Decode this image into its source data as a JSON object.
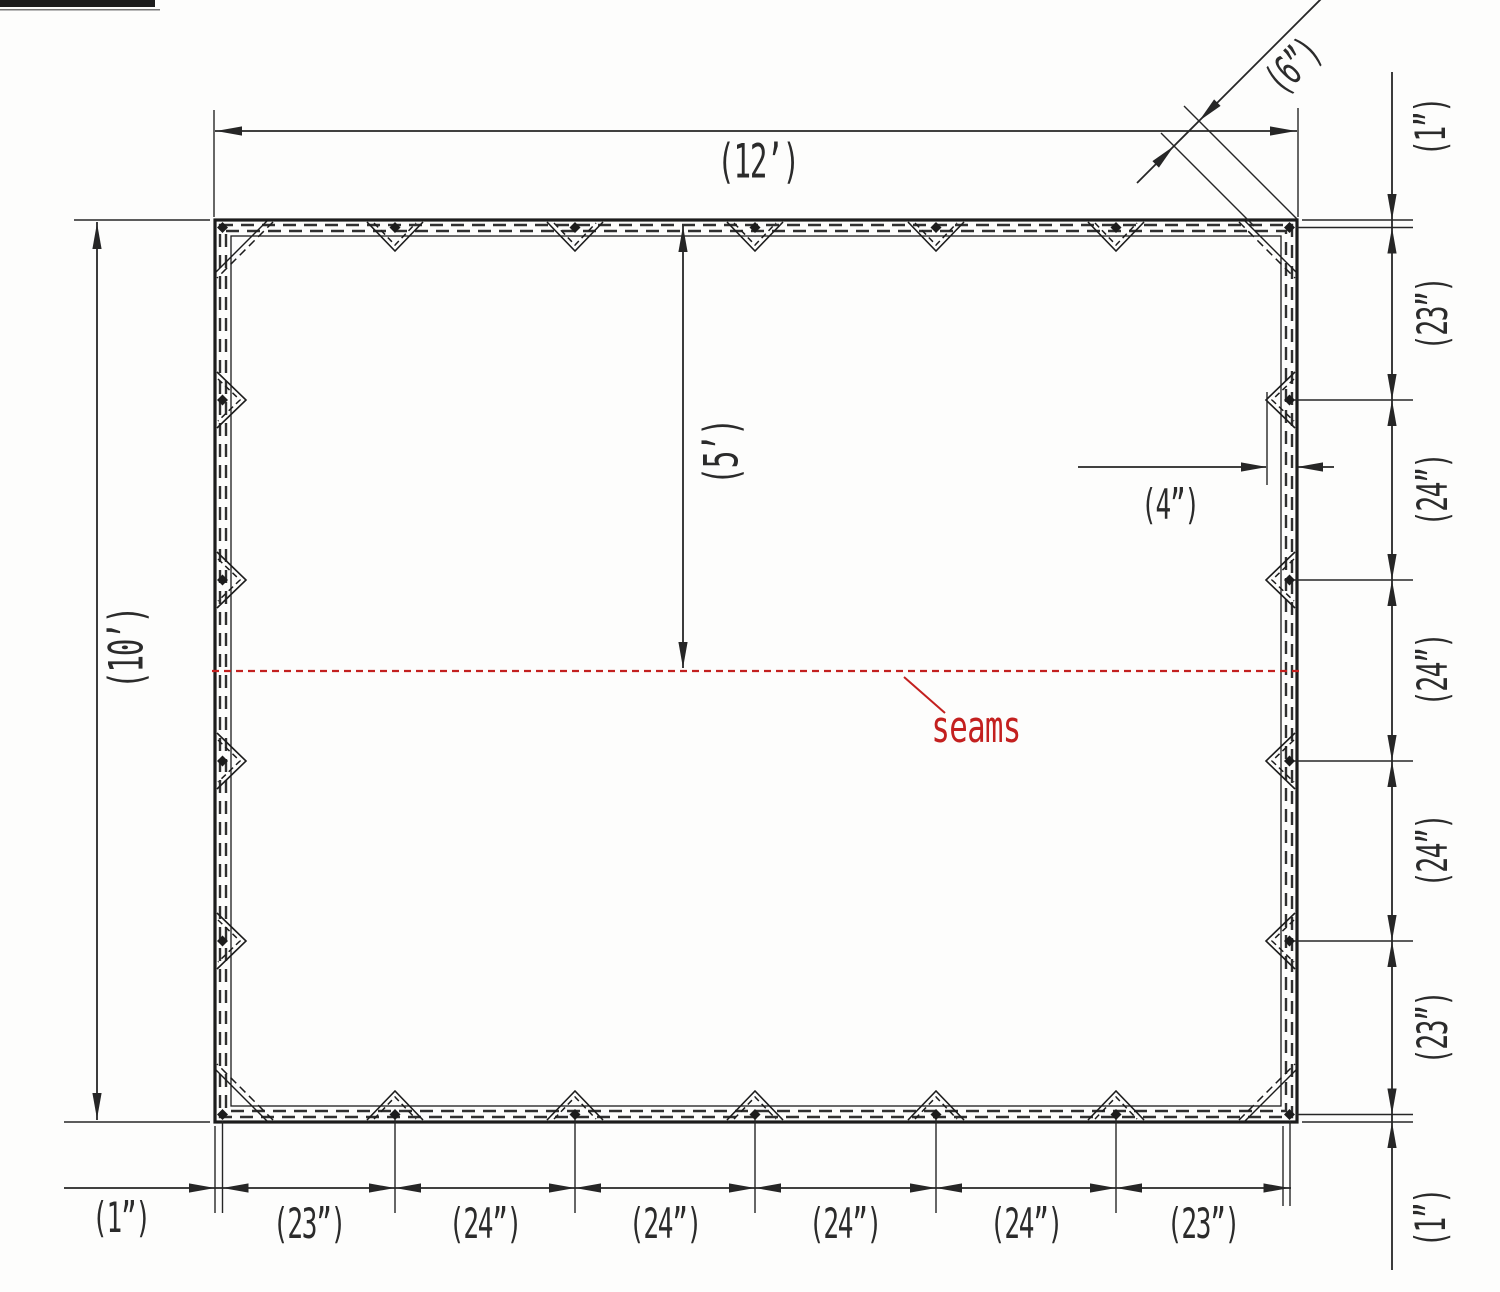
{
  "colors": {
    "ink": "#1c1c1c",
    "dim_line": "#262626",
    "seam_red": "#c3201f",
    "background": "#fdfdfc"
  },
  "overall_dimensions": {
    "width": "(12’)",
    "height": "(10’)",
    "seam_offset": "(5’)"
  },
  "detail_dimensions": {
    "corner_patch": "(6”)",
    "edge_patch": "(4”)"
  },
  "right_chain": [
    "(1”)",
    "(23”)",
    "(24”)",
    "(24”)",
    "(24”)",
    "(23”)",
    "(1”)"
  ],
  "bottom_chain": [
    "(1”)",
    "(23”)",
    "(24”)",
    "(24”)",
    "(24”)",
    "(24”)",
    "(23”)"
  ],
  "annotations": {
    "seams": "seams"
  }
}
